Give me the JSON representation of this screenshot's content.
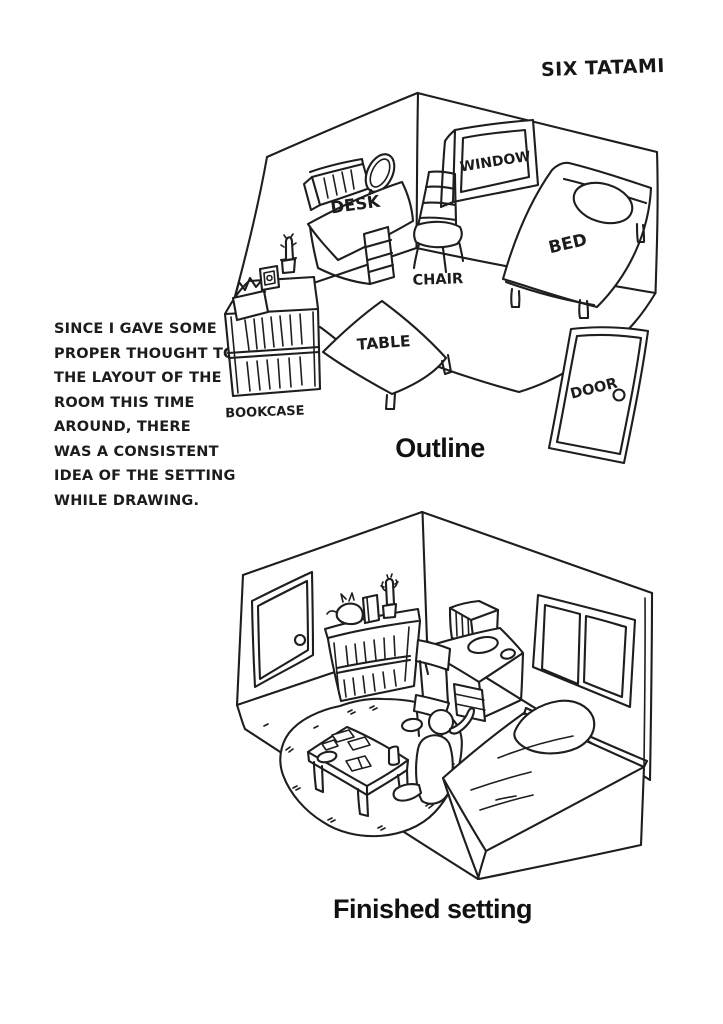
{
  "page": {
    "background": "#ffffff",
    "ink_color": "#1e1e1e"
  },
  "header": {
    "room_size_label": "SIX TATAMI"
  },
  "annotation": {
    "lines": [
      "SINCE I GAVE SOME",
      "PROPER THOUGHT TO",
      "THE LAYOUT OF THE",
      "ROOM THIS TIME",
      "AROUND, THERE",
      "WAS A CONSISTENT",
      "IDEA OF THE SETTING",
      "WHILE DRAWING."
    ]
  },
  "outline_panel": {
    "caption": "Outline",
    "furniture_labels": {
      "window": "WINDOW",
      "desk": "DESK",
      "chair": "CHAIR",
      "bed": "BED",
      "table": "TABLE",
      "bookcase": "BOOKCASE",
      "door": "DOOR"
    }
  },
  "finished_panel": {
    "caption": "Finished setting"
  }
}
